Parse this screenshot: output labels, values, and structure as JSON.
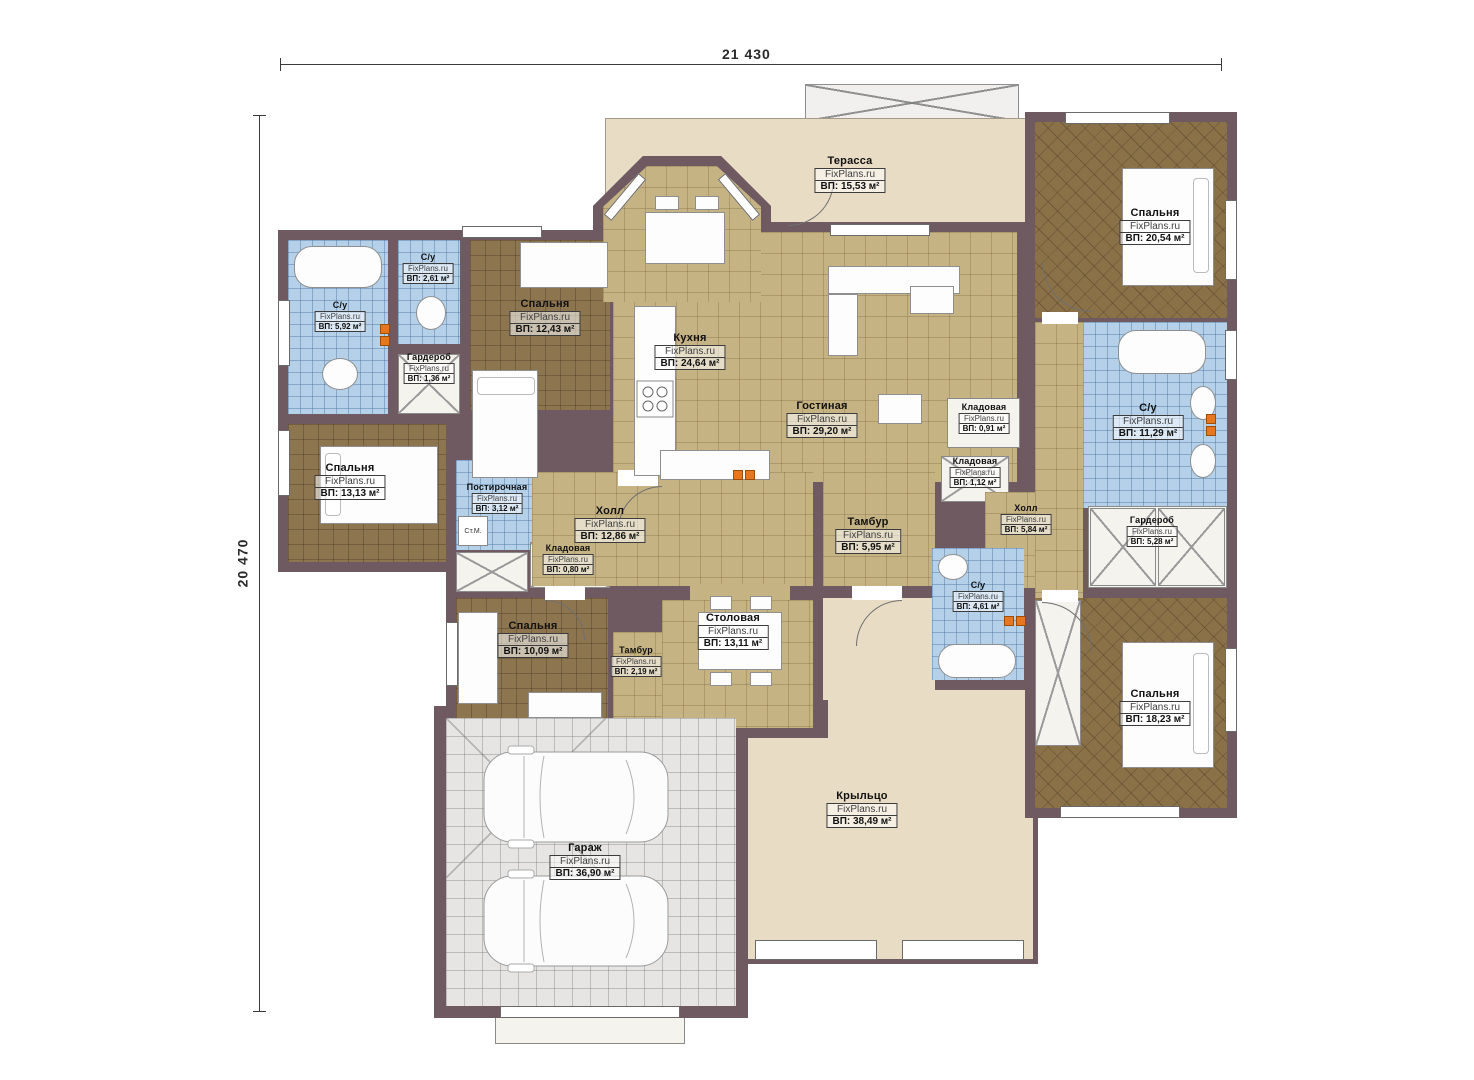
{
  "watermark": "FixPlans.ru",
  "washing_machine_label": "Ст.М.",
  "dimensions": {
    "width_label": "21 430",
    "height_label": "20 470"
  },
  "rooms": {
    "terrace": {
      "name": "Терасса",
      "area": "ВП: 15,53 м²"
    },
    "bedroom_tl": {
      "name": "Спальня",
      "area": "ВП: 12,43 м²"
    },
    "su_small_tl": {
      "name": "С/у",
      "area": "ВП: 2,61 м²"
    },
    "su_left": {
      "name": "С/у",
      "area": "ВП: 5,92 м²"
    },
    "wardrobe_left": {
      "name": "Гардероб",
      "area": "ВП: 1,36 м²"
    },
    "bedroom_ml": {
      "name": "Спальня",
      "area": "ВП: 13,13 м²"
    },
    "laundry": {
      "name": "Постирочная",
      "area": "ВП: 3,12 м²"
    },
    "pantry_left": {
      "name": "Кладовая",
      "area": "ВП: 0,80 м²"
    },
    "bedroom_bl": {
      "name": "Спальня",
      "area": "ВП: 10,09 м²"
    },
    "kitchen": {
      "name": "Кухня",
      "area": "ВП: 24,64 м²"
    },
    "living": {
      "name": "Гостиная",
      "area": "ВП: 29,20 м²"
    },
    "hall_main": {
      "name": "Холл",
      "area": "ВП: 12,86 м²"
    },
    "tambur_main": {
      "name": "Тамбур",
      "area": "ВП: 5,95 м²"
    },
    "dining": {
      "name": "Столовая",
      "area": "ВП: 13,11 м²"
    },
    "tambur_small": {
      "name": "Тамбур",
      "area": "ВП: 2,19 м²"
    },
    "pantry_c1": {
      "name": "Кладовая",
      "area": "ВП: 0,91 м²"
    },
    "pantry_c2": {
      "name": "Кладовая",
      "area": "ВП: 1,12 м²"
    },
    "hall_right": {
      "name": "Холл",
      "area": "ВП: 5,84 м²"
    },
    "su_right": {
      "name": "С/у",
      "area": "ВП: 11,29 м²"
    },
    "wardrobe_right": {
      "name": "Гардероб",
      "area": "ВП: 5,28 м²"
    },
    "su_center": {
      "name": "С/у",
      "area": "ВП: 4,61 м²"
    },
    "bedroom_tr": {
      "name": "Спальня",
      "area": "ВП: 20,54 м²"
    },
    "bedroom_br": {
      "name": "Спальня",
      "area": "ВП: 18,23 м²"
    },
    "porch": {
      "name": "Крыльцо",
      "area": "ВП: 38,49 м²"
    },
    "garage": {
      "name": "Гараж",
      "area": "ВП: 36,90 м²"
    }
  }
}
